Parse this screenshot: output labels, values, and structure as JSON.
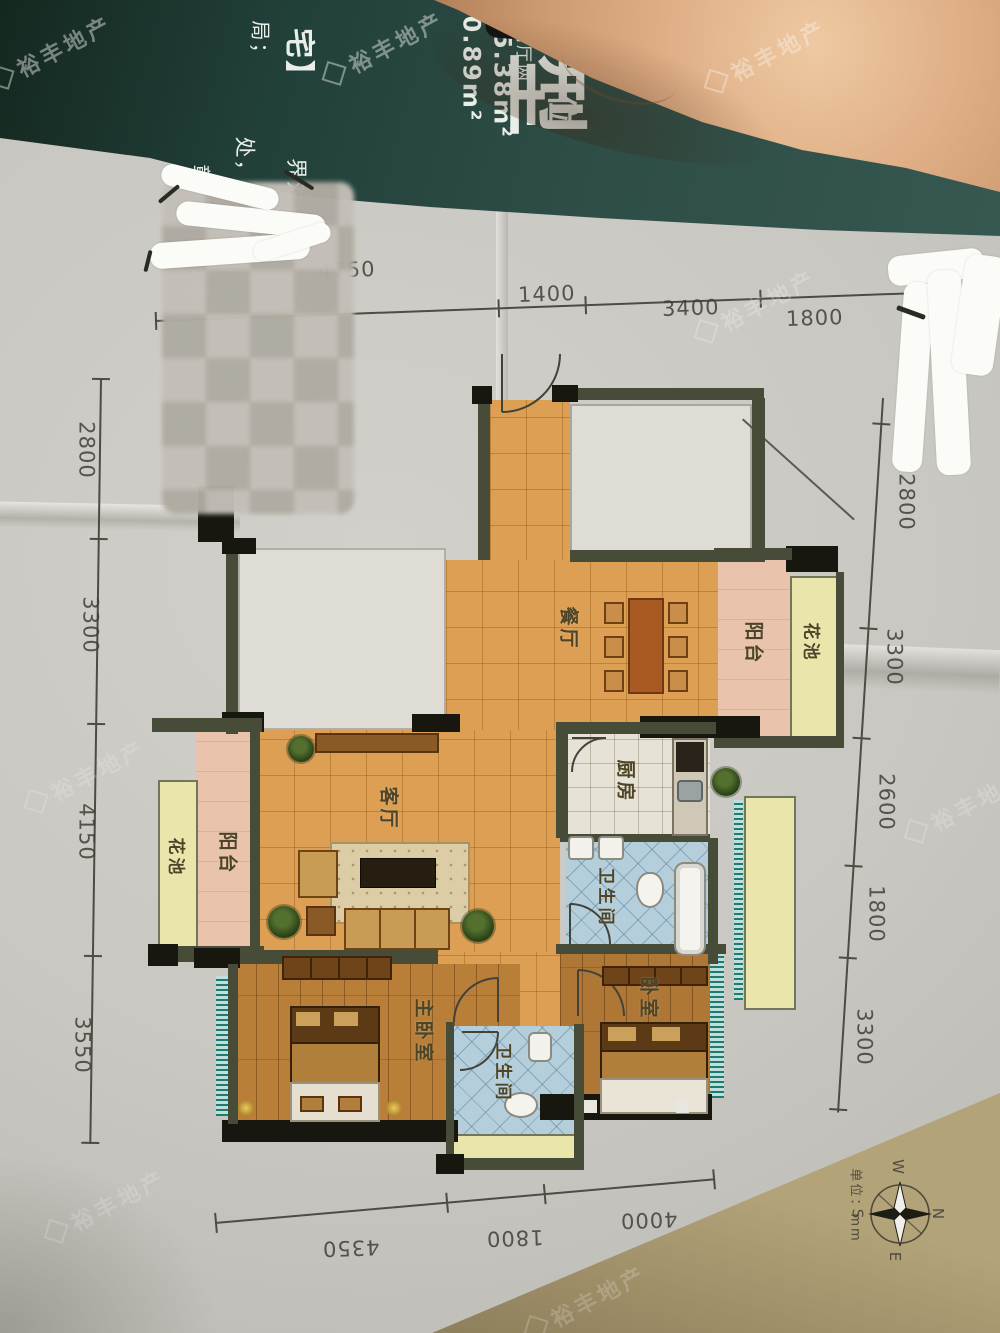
{
  "watermark": {
    "text": "裕丰地产"
  },
  "brochure": {
    "headline_char": "型",
    "headline_char2": "位",
    "spec_column": "房两厅两卫",
    "area1": "0.89m²",
    "area2": "15.38m²",
    "fragment_top": "局；",
    "fragment_bracket": "宅】",
    "tagline1": "界对话无边园景；",
    "tagline2": "处，把酒言欢；",
    "tagline3": "彰显大家风范。"
  },
  "plan": {
    "rooms": {
      "dining": "餐厅",
      "living": "客厅",
      "kitchen": "厨房",
      "bath_upper": "卫生间",
      "bath_lower": "卫生间",
      "master_bedroom": "主卧室",
      "bedroom": "卧室",
      "balcony_right": "阳台",
      "flowerbed_right": "花池",
      "balcony_left": "阳台",
      "flowerbed_left": "花池"
    },
    "dims_top": [
      "4750",
      "1400",
      "3400",
      "1800"
    ],
    "dims_left": [
      "2800",
      "3300",
      "4150",
      "3550"
    ],
    "dims_right": [
      "2800",
      "3300",
      "2600",
      "1800",
      "3300"
    ],
    "dims_bottom": [
      "4350",
      "1800",
      "4000"
    ],
    "compass": {
      "n": "N",
      "s": "S",
      "e": "E",
      "w": "W"
    },
    "unit_note": "单位：mm"
  }
}
